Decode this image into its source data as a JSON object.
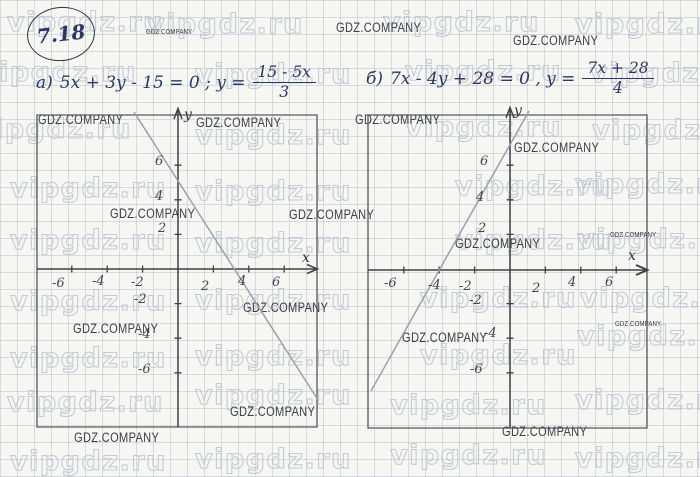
{
  "watermarks": {
    "vip": "vipgdz.ru",
    "gdz": "GDZ.COMPANY"
  },
  "problem": {
    "number": "7.18"
  },
  "equations": {
    "a": {
      "label": "а)",
      "body": "5x + 3y - 15 = 0 ;  y =",
      "numerator": "15 - 5x",
      "denominator": "3"
    },
    "b": {
      "label": "б)",
      "body": "7x - 4y + 28 = 0 ,  y =",
      "numerator": "7x + 28",
      "denominator": "4"
    }
  },
  "graphs": [
    {
      "id": "a",
      "x_label": "x",
      "y_label": "y",
      "x_ticks": [
        "-6",
        "-4",
        "-2",
        "2",
        "4",
        "6"
      ],
      "y_ticks": [
        "6",
        "4",
        "2",
        "-2",
        "-4",
        "-6"
      ]
    },
    {
      "id": "b",
      "x_label": "x",
      "y_label": "y",
      "x_ticks": [
        "-6",
        "-4",
        "-2",
        "2",
        "4",
        "6"
      ],
      "y_ticks": [
        "6",
        "4",
        "2",
        "-2",
        "-4",
        "-6"
      ]
    }
  ],
  "chart_data": [
    {
      "type": "line",
      "title": "а) 5x + 3y - 15 = 0",
      "equation": "y = (15 - 5x) / 3",
      "slope": -1.667,
      "y_intercept": 5,
      "x_intercept": 3,
      "x": [
        -2.5,
        7.9
      ],
      "y": [
        9.2,
        -8.2
      ],
      "xlim": [
        -7.9,
        7.8
      ],
      "ylim": [
        -9.1,
        8.9
      ],
      "x_tick_labels": [
        -6,
        -4,
        -2,
        2,
        4,
        6
      ],
      "y_tick_labels": [
        6,
        4,
        2,
        -2,
        -4,
        -6
      ],
      "grid": true,
      "legend": false
    },
    {
      "type": "line",
      "title": "б) 7x - 4y + 28 = 0",
      "equation": "y = (7x + 28) / 4",
      "slope": 1.75,
      "y_intercept": 7,
      "x_intercept": -4,
      "x": [
        -7.9,
        1.05
      ],
      "y": [
        -6.8,
        8.8
      ],
      "xlim": [
        -8,
        7.7
      ],
      "ylim": [
        -9.2,
        8.9
      ],
      "x_tick_labels": [
        -6,
        -4,
        -2,
        2,
        4,
        6
      ],
      "y_tick_labels": [
        6,
        4,
        2,
        -2,
        -4,
        -6
      ],
      "grid": true,
      "legend": false
    }
  ]
}
